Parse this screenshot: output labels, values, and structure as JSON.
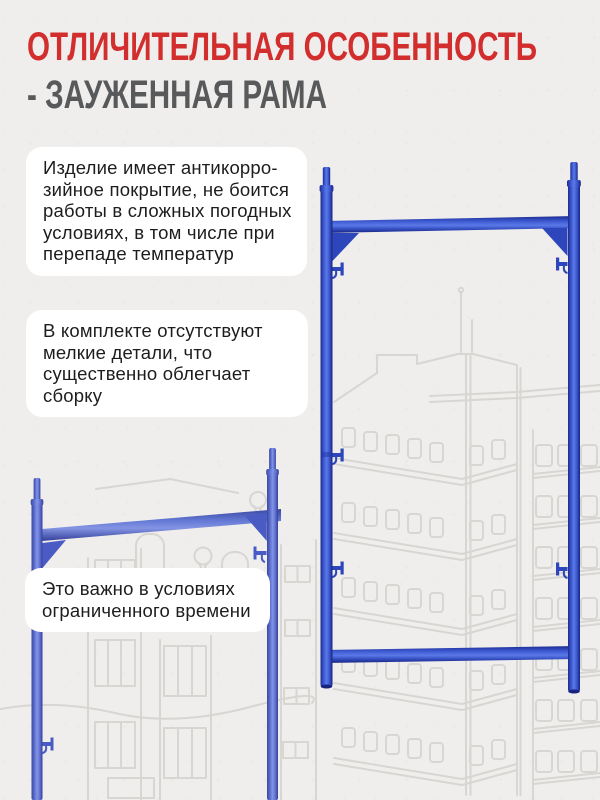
{
  "title": {
    "line1": "ОТЛИЧИТЕЛЬНАЯ ОСОБЕННОСТЬ",
    "line2": "- ЗАУЖЕННАЯ РАМА"
  },
  "cards": [
    {
      "id": "anticorrosion-coating",
      "lines": [
        "Изделие имеет антикорро-",
        "зийное покрытие, не боится",
        "работы в сложных погодных",
        "условиях, в том числе при",
        "перепаде температур"
      ]
    },
    {
      "id": "no-small-parts",
      "lines": [
        "В комплекте отсутствуют",
        "мелкие детали, что",
        "существенно облегчает",
        "сборку"
      ]
    },
    {
      "id": "limited-time",
      "lines": [
        "Это важно в условиях",
        "ограниченного времени"
      ]
    }
  ],
  "images": {
    "main_product": "blue-narrowed-scaffold-frame",
    "secondary_product": "blue-narrowed-scaffold-frame-angled",
    "background": "faint-building-line-sketch"
  },
  "colors": {
    "accent_red": "#d22e2e",
    "subtitle_gray": "#58595b",
    "body_text": "#1d1d1f",
    "card_white": "#ffffff",
    "background": "#efeeec",
    "sketch_gray": "#d7d6d3",
    "frame_blue_mid": "#4360d8",
    "frame_blue_dark": "#1b2a8e",
    "secondary_frame_blue": "#6b7fd8"
  }
}
